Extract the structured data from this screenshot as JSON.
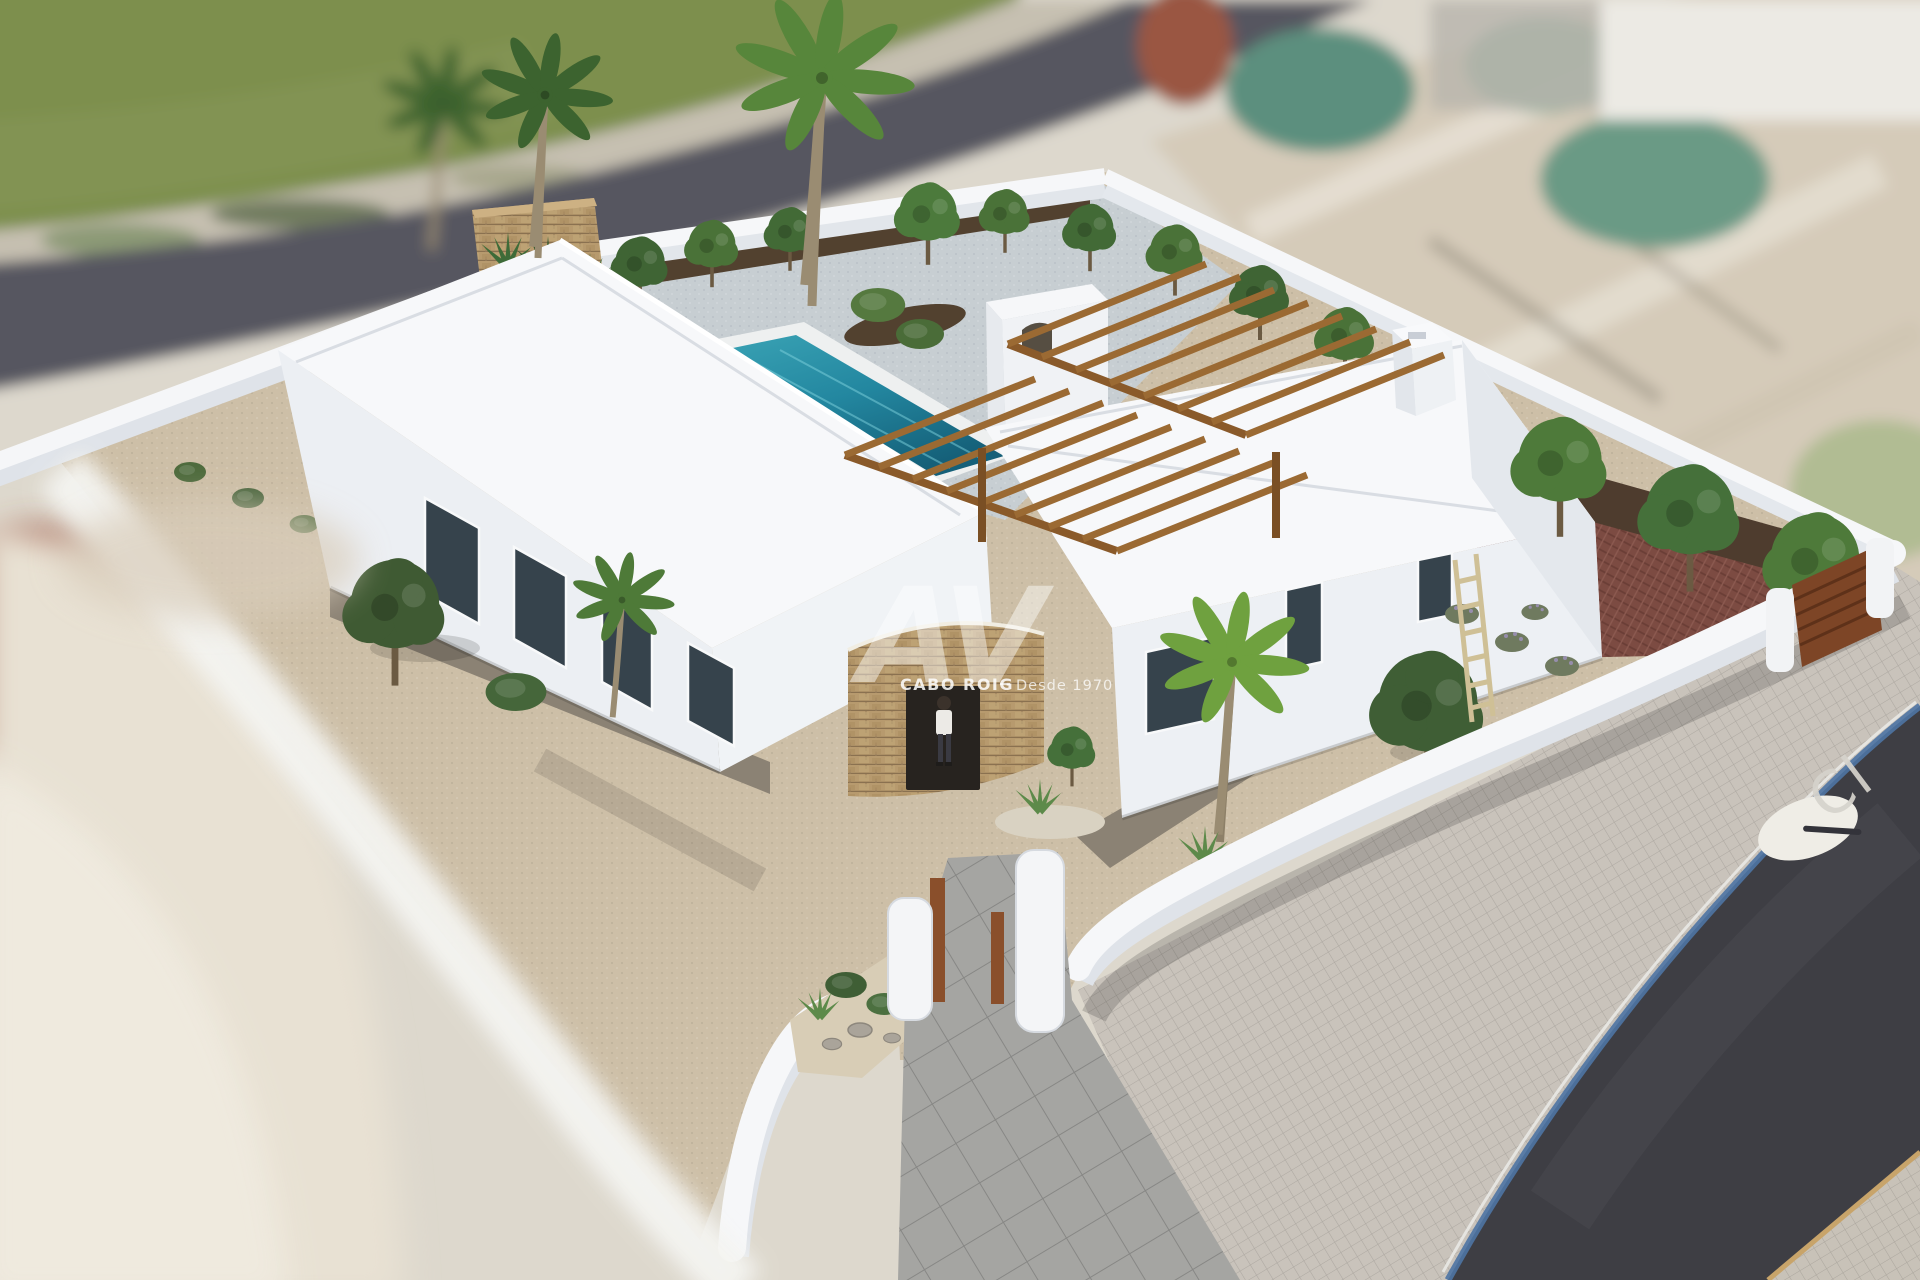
{
  "scene": {
    "type": "architectural-aerial-render",
    "watermark": {
      "logo": "AV",
      "brand": "CABO ROIG",
      "tagline": "Desde 1970"
    },
    "road": {
      "street_label": "Cl"
    },
    "palette": {
      "grass": "#7d8f4d",
      "road_back": "#565660",
      "road_front": "#3e3e44",
      "curb_blue": "#4e74a4",
      "gravel": "#cdbfa7",
      "pool_deck_gravel": "#c7ced2",
      "mulch": "#52412f",
      "red_paving": "#7c4b42",
      "wall_white": "#f5f6f8",
      "pool_water": "#2a8ba2",
      "pergola_wood": "#9b6a33",
      "corten": "#8a4f2b",
      "stone_wall": "#b79a6e",
      "sidewalk": "#c9c3bb",
      "foreground_blur": "#e8e1d3"
    }
  }
}
